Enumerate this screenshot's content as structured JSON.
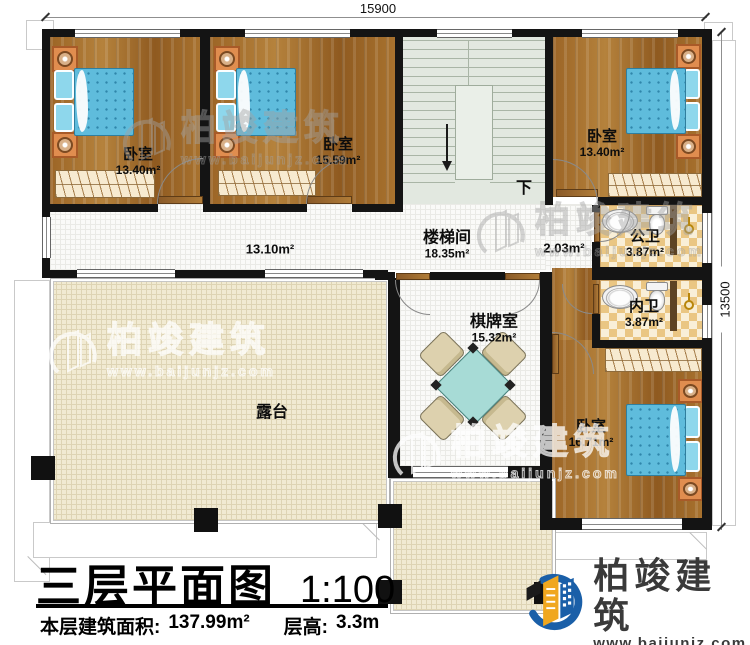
{
  "dimensions": {
    "top_width": "15900",
    "right_height": "13500"
  },
  "rooms": {
    "bedroom1": {
      "name": "卧室",
      "area": "13.40m²"
    },
    "bedroom2": {
      "name": "卧室",
      "area": "15.59m²"
    },
    "bedroom3": {
      "name": "卧室",
      "area": "13.40m²"
    },
    "bedroom4": {
      "name": "卧室",
      "area": "16.71m²"
    },
    "stairwell": {
      "name": "楼梯间",
      "area": "18.35m²"
    },
    "game_room": {
      "name": "棋牌室",
      "area": "15.32m²"
    },
    "public_bath": {
      "name": "公卫",
      "area": "3.87m²"
    },
    "inner_bath": {
      "name": "内卫",
      "area": "3.87m²"
    },
    "terrace": {
      "name": "露台"
    },
    "corridor": {
      "area": "13.10m²"
    },
    "stair_lobby": {
      "area": "2.03m²"
    }
  },
  "annotations": {
    "stairs_down": "下"
  },
  "title_block": {
    "title": "三层平面图",
    "scale": "1:100",
    "floor_area_label": "本层建筑面积:",
    "floor_area_value": "137.99m²",
    "floor_height_label": "层高:",
    "floor_height_value": "3.3m"
  },
  "brand": {
    "name": "柏竣建筑",
    "website": "www.baijunjz.com"
  },
  "watermark": {
    "name": "柏竣建筑",
    "website": "www.baijunjz.com"
  },
  "colors": {
    "wall": "#141414",
    "wood": "#a5702c",
    "bed_blue": "#5fbcdc",
    "terrace": "#f1ead2",
    "stair": "#e2e8e0",
    "tile": "#eac683",
    "table_teal": "#a7dbd6",
    "brand_blue": "#1a5fa8",
    "brand_yellow": "#f0a71f"
  }
}
